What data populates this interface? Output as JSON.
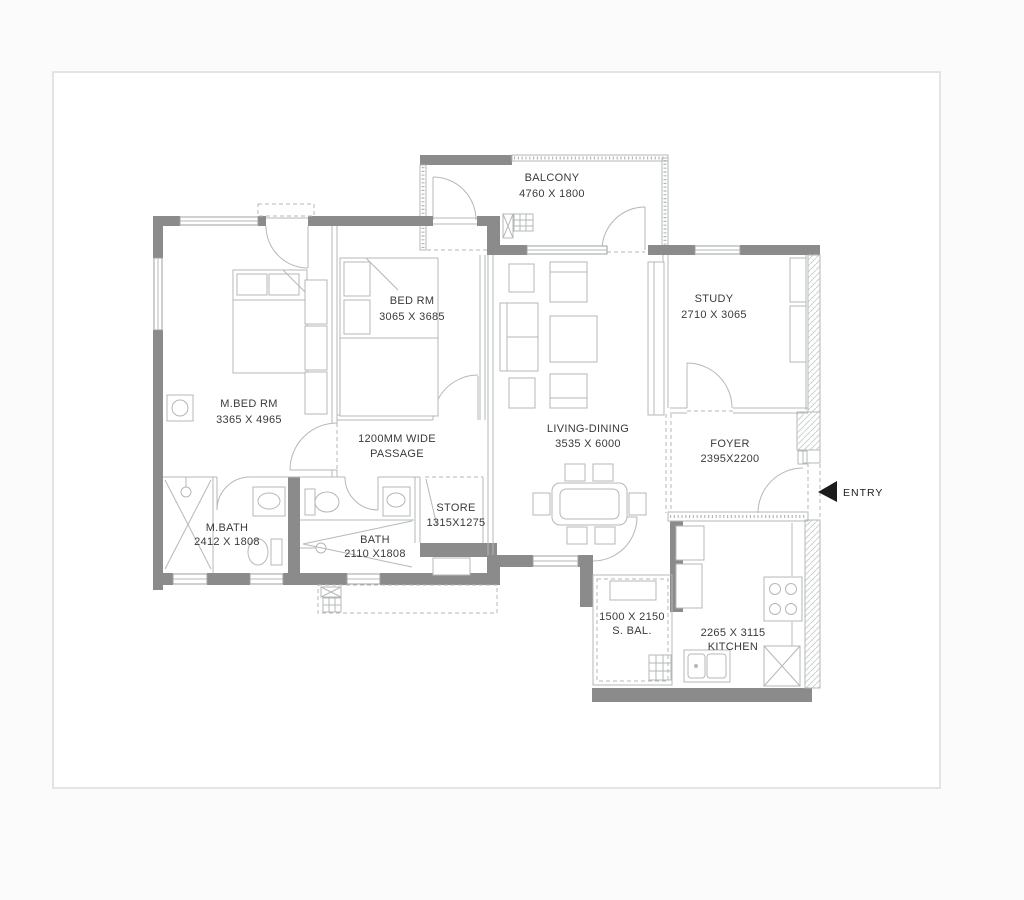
{
  "page": {
    "background": "#ffffff",
    "border_color": "#dcdcdc"
  },
  "colors": {
    "wall": "#8b8b8b",
    "thin_line": "#b4b8b8",
    "text": "#3a3a3a",
    "entry_arrow": "#1c1c1c"
  },
  "plan": {
    "entry_label": "ENTRY",
    "rooms": [
      {
        "key": "balcony",
        "lines": [
          "BALCONY",
          "4760 X 1800"
        ],
        "x": 552,
        "y": 181
      },
      {
        "key": "bed-room",
        "lines": [
          "BED RM",
          "3065 X 3685"
        ],
        "x": 412,
        "y": 304
      },
      {
        "key": "study",
        "lines": [
          "STUDY",
          "2710 X 3065"
        ],
        "x": 714,
        "y": 302
      },
      {
        "key": "master-bed-room",
        "lines": [
          "M.BED RM",
          "3365 X 4965"
        ],
        "x": 249,
        "y": 407
      },
      {
        "key": "passage",
        "lines": [
          "1200MM WIDE",
          "PASSAGE"
        ],
        "x": 397,
        "y": 442
      },
      {
        "key": "living-dining",
        "lines": [
          "LIVING-DINING",
          "3535 X 6000"
        ],
        "x": 588,
        "y": 432
      },
      {
        "key": "foyer",
        "lines": [
          "FOYER",
          "2395X2200"
        ],
        "x": 730,
        "y": 447
      },
      {
        "key": "master-bath",
        "lines": [
          "M.BATH",
          "2412 X 1808"
        ],
        "x": 227,
        "y": 531
      },
      {
        "key": "bath",
        "lines": [
          "BATH",
          "2110 X1808"
        ],
        "x": 375,
        "y": 543
      },
      {
        "key": "store",
        "lines": [
          "STORE",
          "1315X1275"
        ],
        "x": 456,
        "y": 511
      },
      {
        "key": "service-balcony",
        "lines": [
          "1500 X 2150",
          "S. BAL."
        ],
        "x": 632,
        "y": 620
      },
      {
        "key": "kitchen",
        "lines": [
          "2265 X 3115",
          "KITCHEN"
        ],
        "x": 733,
        "y": 636
      }
    ]
  }
}
